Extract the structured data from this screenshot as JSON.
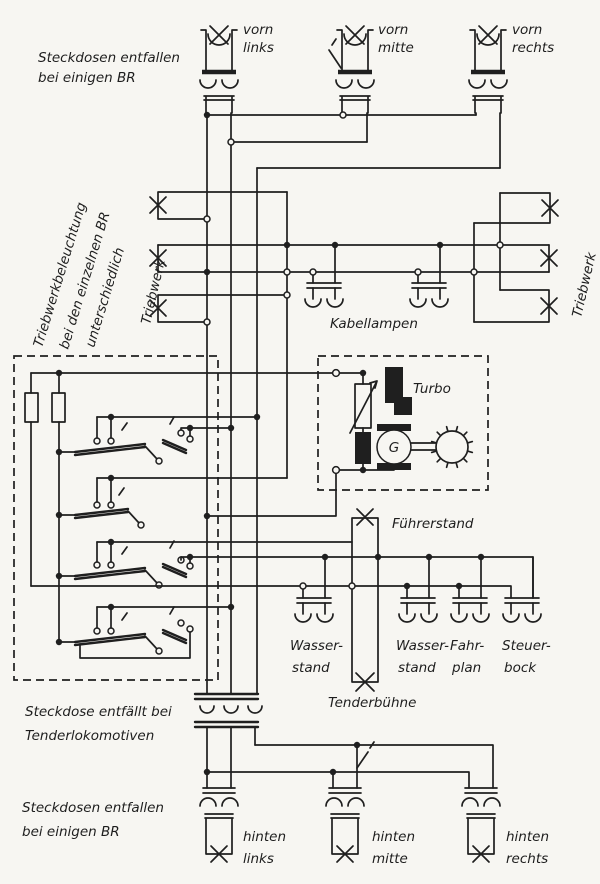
{
  "colors": {
    "ink": "#1f1f1f",
    "paper": "#f7f6f2"
  },
  "notes": {
    "top": [
      "Steckdosen entfallen",
      "bei einigen BR"
    ],
    "engine": [
      "Triebwerkbeleuchtung",
      "bei den einzelnen BR",
      "unterschiedlich"
    ],
    "tender": [
      "Steckdose entfällt bei",
      "Tenderlokomotiven"
    ],
    "bottom": [
      "Steckdosen entfallen",
      "bei einigen BR"
    ]
  },
  "front_lamps": [
    {
      "line1": "vorn",
      "line2": "links"
    },
    {
      "line1": "vorn",
      "line2": "mitte"
    },
    {
      "line1": "vorn",
      "line2": "rechts"
    }
  ],
  "rear_lamps": [
    {
      "line1": "hinten",
      "line2": "links"
    },
    {
      "line1": "hinten",
      "line2": "mitte"
    },
    {
      "line1": "hinten",
      "line2": "rechts"
    }
  ],
  "cab_sockets": [
    {
      "line1": "Wasser-",
      "line2": "stand"
    },
    {
      "line1": "Wasser-",
      "line2": "stand"
    },
    {
      "line1": "Fahr-",
      "line2": "plan"
    },
    {
      "line1": "Steuer-",
      "line2": "bock"
    }
  ],
  "labels": {
    "triebwerk_left": "Triebwerk",
    "triebwerk_right": "Triebwerk",
    "kabellampen": "Kabellampen",
    "turbo": "Turbo",
    "generator": "G",
    "fuehrerstand": "Führerstand",
    "tenderbuehne": "Tenderbühne"
  }
}
